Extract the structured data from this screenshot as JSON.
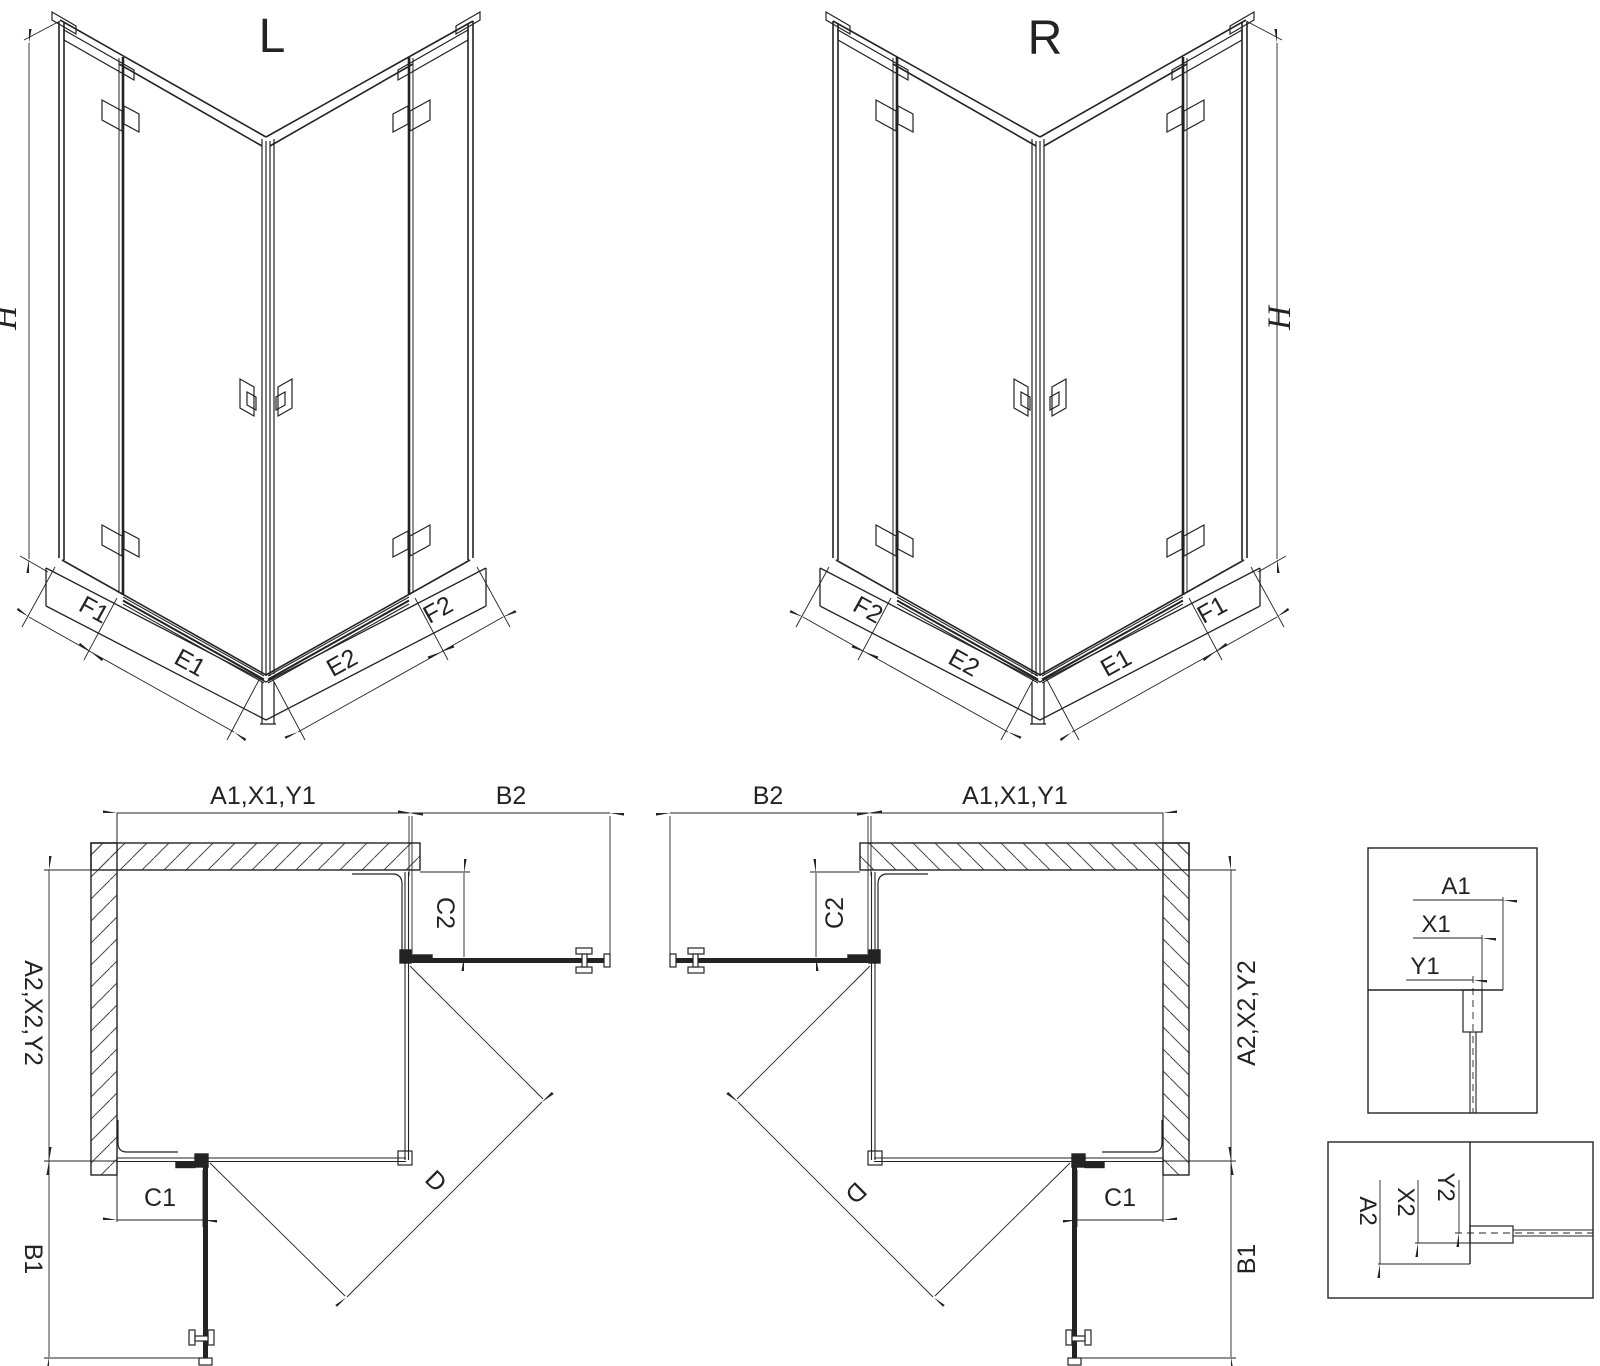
{
  "iso_left": {
    "title": "L",
    "height": "H",
    "segments": [
      "F1",
      "E1",
      "E2",
      "F2"
    ]
  },
  "iso_right": {
    "title": "R",
    "height": "H",
    "segments": [
      "F2",
      "E2",
      "E1",
      "F1"
    ]
  },
  "plan_left": {
    "width_top": "A1,X1,Y1",
    "door_open_top": "B2",
    "fixed_top": "C2",
    "depth_side": "A2,X2,Y2",
    "fixed_bottom": "C1",
    "door_open_bottom": "B1",
    "diagonal": "D"
  },
  "plan_right": {
    "width_top": "A1,X1,Y1",
    "door_open_top": "B2",
    "fixed_top": "C2",
    "depth_side": "A2,X2,Y2",
    "fixed_bottom": "C1",
    "door_open_bottom": "B1",
    "diagonal": "D"
  },
  "detail_horizontal": {
    "dims": [
      "A1",
      "X1",
      "Y1"
    ]
  },
  "detail_vertical": {
    "dims": [
      "A2",
      "X2",
      "Y2"
    ]
  },
  "colors": {
    "ink": "#232323",
    "paper": "#ffffff"
  }
}
